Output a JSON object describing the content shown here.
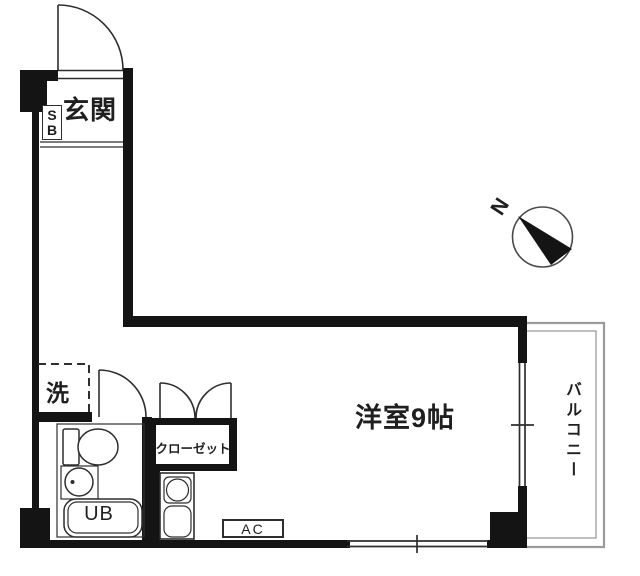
{
  "labels": {
    "entrance": "玄関",
    "shoe_box_s": "S",
    "shoe_box_b": "B",
    "laundry": "洗",
    "unit_bath": "UB",
    "closet": "クローゼット",
    "western_room": "洋室9帖",
    "balcony": "バルコニー",
    "air_con": "AC",
    "compass_north": "N"
  },
  "colors": {
    "wall": "#141414",
    "line": "#2e2e2e",
    "balcony": "#9b9b9b",
    "bg": "#ffffff",
    "text": "#1f1f1f"
  }
}
